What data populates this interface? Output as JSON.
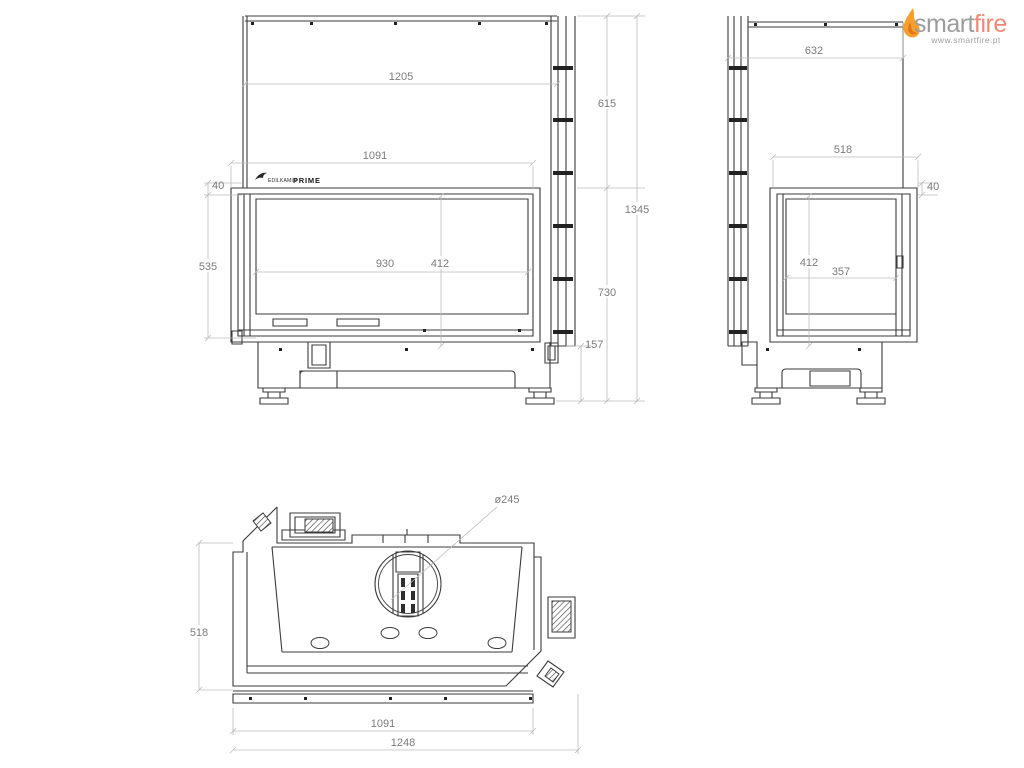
{
  "branding": {
    "logo": {
      "word_primary": "smart",
      "word_secondary": "fire",
      "url": "www.smartfire.pt",
      "color_primary": "#9c9c9c",
      "color_secondary": "#ee8a74",
      "flame_outer": "#f6a02c",
      "flame_inner": "#e5731d"
    },
    "product_mark": {
      "maker_text": "EDILKAMIN",
      "model_text": "PRIME"
    }
  },
  "drawing": {
    "line_color": "#3b3b3b",
    "dim_line_color": "#bcbcbc",
    "dim_text_color": "#7b7b7b",
    "views": {
      "front": {
        "dims": {
          "panel_width": "1205",
          "opening_width": "1091",
          "frame_offset": "40",
          "glass_height": "535",
          "glass_width": "930",
          "inner_height": "412",
          "panel_height": "615",
          "total_height": "1345",
          "body_height": "730",
          "base_height": "157"
        }
      },
      "side": {
        "dims": {
          "panel_width": "632",
          "opening_width": "518",
          "frame_offset": "40",
          "inner_height": "412",
          "glass_width": "357"
        }
      },
      "top": {
        "dims": {
          "flue_diameter": "ø245",
          "depth": "518",
          "opening_width": "1091",
          "total_width": "1248"
        }
      }
    }
  }
}
